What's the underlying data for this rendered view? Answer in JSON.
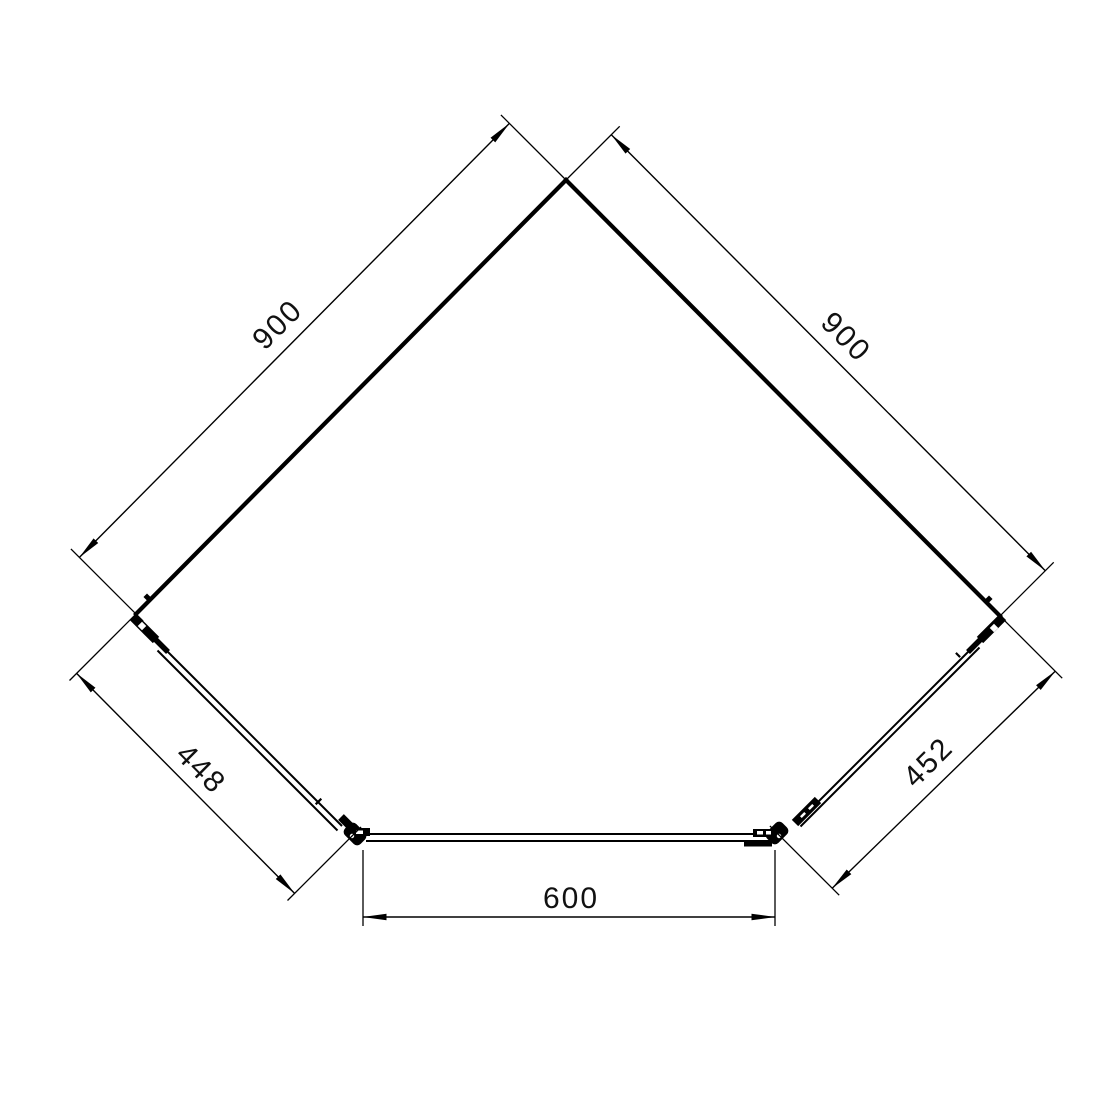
{
  "drawing": {
    "background": "#ffffff",
    "line_color": "#000000",
    "dimensions": {
      "left_wall": "900",
      "right_wall": "900",
      "left_front_panel": "448",
      "right_front_panel": "452",
      "door_width": "600"
    }
  }
}
